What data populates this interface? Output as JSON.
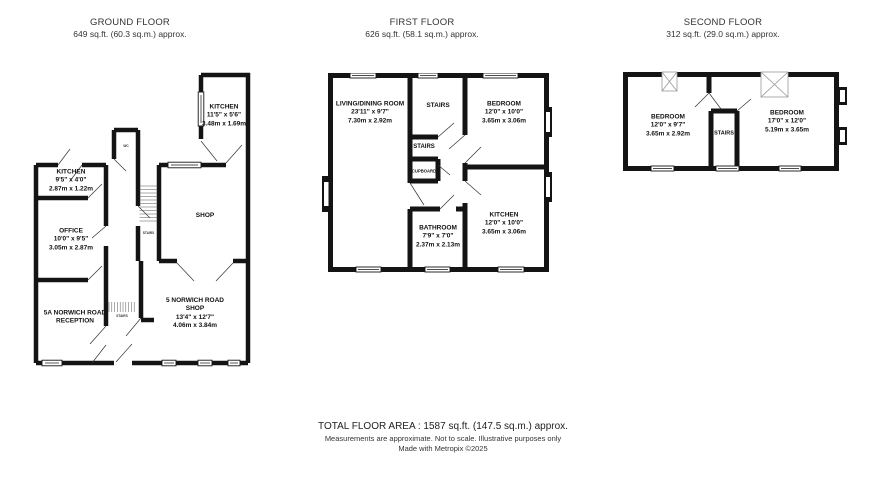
{
  "colors": {
    "wall": "#141414",
    "text": "#222222",
    "hatch": "#555555",
    "skylight_outline": "#999999"
  },
  "floors": [
    {
      "title": "GROUND FLOOR",
      "area": "649 sq.ft. (60.3 sq.m.) approx.",
      "rooms": {
        "kitchen_rear": {
          "name": "KITCHEN",
          "imperial": "11'5\" x 5'6\"",
          "metric": "3.48m x 1.69m"
        },
        "kitchen_left": {
          "name": "KITCHEN",
          "imperial": "9'5\" x 4'0\"",
          "metric": "2.87m x 1.22m"
        },
        "office": {
          "name": "OFFICE",
          "imperial": "10'0\" x 9'5\"",
          "metric": "3.05m x 2.87m"
        },
        "shop": {
          "name": "SHOP"
        },
        "reception": {
          "name": "5A NORWICH ROAD",
          "name2": "RECEPTION"
        },
        "shop5": {
          "name": "5 NORWICH ROAD",
          "name2": "SHOP",
          "imperial": "13'4\" x 12'7\"",
          "metric": "4.06m x 3.84m"
        },
        "wc": {
          "name": "WC"
        },
        "stairs_mid": {
          "name": "STAIRS"
        },
        "stairs_entrance": {
          "name": "STAIRS"
        }
      }
    },
    {
      "title": "FIRST FLOOR",
      "area": "626 sq.ft. (58.1 sq.m.) approx.",
      "rooms": {
        "living": {
          "name": "LIVING/DINING ROOM",
          "imperial": "23'11\" x 9'7\"",
          "metric": "7.30m x 2.92m"
        },
        "stairs_top": {
          "name": "STAIRS"
        },
        "bedroom": {
          "name": "BEDROOM",
          "imperial": "12'0\" x 10'0\"",
          "metric": "3.65m x 3.06m"
        },
        "stairs_mid": {
          "name": "STAIRS"
        },
        "cupboard": {
          "name": "CUPBOARD"
        },
        "bathroom": {
          "name": "BATHROOM",
          "imperial": "7'9\" x 7'0\"",
          "metric": "2.37m x 2.13m"
        },
        "kitchen": {
          "name": "KITCHEN",
          "imperial": "12'0\" x 10'0\"",
          "metric": "3.65m x 3.06m"
        }
      }
    },
    {
      "title": "SECOND FLOOR",
      "area": "312 sq.ft. (29.0 sq.m.) approx.",
      "rooms": {
        "bedroom_left": {
          "name": "BEDROOM",
          "imperial": "12'0\" x 9'7\"",
          "metric": "3.65m x 2.92m"
        },
        "stairs": {
          "name": "STAIRS"
        },
        "bedroom_right": {
          "name": "BEDROOM",
          "imperial": "17'0\" x 12'0\"",
          "metric": "5.19m x 3.65m"
        }
      }
    }
  ],
  "footer": {
    "total": "TOTAL FLOOR AREA : 1587 sq.ft. (147.5 sq.m.) approx.",
    "note": "Measurements are approximate.  Not to scale.  Illustrative purposes only",
    "made_with": "Made with Metropix ©2025"
  }
}
